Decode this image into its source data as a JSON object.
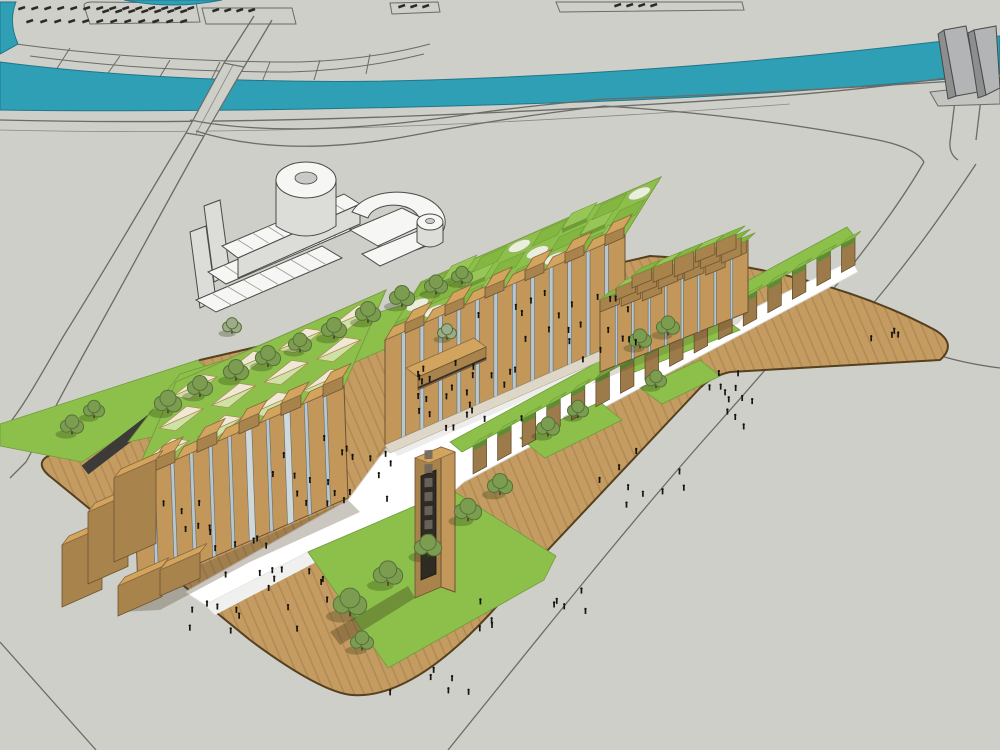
{
  "meta": {
    "kind": "3d-architectural-site-rendering",
    "style": "sketchup-massing-model",
    "view": "aerial-oblique"
  },
  "palette": {
    "ground": "#cfcfc9",
    "roadline": "#6b6b67",
    "river": "#2f9fb5",
    "riverdark": "#20768a",
    "deck": "#c49b61",
    "deckedge": "#55401f",
    "walk": "#ffffff",
    "path": "#3c3b37",
    "lawn": "#8cc04a",
    "lawndark": "#6f9c39",
    "roofgreen": "#8cc04a",
    "woodA": "#c29759",
    "woodB": "#a9834c",
    "woodtop": "#d3a45e",
    "glass": "#b9c6cb",
    "glassdark": "#8fa3ab",
    "whitebldg": "#f6f6f4",
    "whiteside": "#dcdcd9",
    "tower": "#b3b4b6",
    "towerside": "#8c8e90",
    "people": "#16140f",
    "treefill": "#7c9d50",
    "treedark": "#55713a",
    "treesage": "#9cab88",
    "cream": "#efe8d4",
    "pyrgreen": "#cfe2a6"
  },
  "scene": {
    "hatch_rows": [
      {
        "x": 18,
        "y": 8,
        "n": 14,
        "step": 13
      },
      {
        "x": 26,
        "y": 21,
        "n": 12,
        "step": 14
      },
      {
        "x": 102,
        "y": 11,
        "n": 7,
        "step": 13
      },
      {
        "x": 212,
        "y": 10,
        "n": 4,
        "step": 12
      },
      {
        "x": 398,
        "y": 6,
        "n": 3,
        "step": 12
      },
      {
        "x": 614,
        "y": 5,
        "n": 4,
        "step": 12
      }
    ],
    "left_building": {
      "front": [
        [
          138,
          590
        ],
        [
          348,
          498
        ],
        [
          344,
          386
        ],
        [
          134,
          478
        ]
      ],
      "roof": [
        [
          134,
          478
        ],
        [
          344,
          386
        ],
        [
          386,
          290
        ],
        [
          176,
          382
        ]
      ],
      "pyramid_grid": {
        "cols": 4,
        "rows": 3
      },
      "glass_slots": 10,
      "door_slots": [
        6,
        8
      ],
      "top_blocks": 10,
      "wings": [
        {
          "x": 62,
          "y": 545,
          "w": 40,
          "h": 62
        },
        {
          "x": 88,
          "y": 512,
          "w": 40,
          "h": 72
        },
        {
          "x": 114,
          "y": 478,
          "w": 42,
          "h": 84
        },
        {
          "x": 118,
          "y": 586,
          "w": 44,
          "h": 30
        },
        {
          "x": 160,
          "y": 570,
          "w": 40,
          "h": 26
        }
      ]
    },
    "middle_building": {
      "front": [
        [
          385,
          445
        ],
        [
          625,
          340
        ],
        [
          625,
          235
        ],
        [
          385,
          340
        ]
      ],
      "roof": [
        [
          385,
          340
        ],
        [
          625,
          235
        ],
        [
          661,
          177
        ],
        [
          421,
          282
        ]
      ],
      "cube_grid": {
        "cols": 8,
        "rows": 3
      },
      "glass_slots": 12,
      "top_blocks": 12,
      "canopy": {
        "top": [
          [
            406,
            368
          ],
          [
            474,
            338
          ],
          [
            486,
            347
          ],
          [
            418,
            377
          ]
        ],
        "face": [
          [
            418,
            377
          ],
          [
            486,
            347
          ],
          [
            486,
            360
          ],
          [
            418,
            390
          ]
        ]
      }
    },
    "right_building": {
      "front": [
        [
          600,
          372
        ],
        [
          748,
          312
        ],
        [
          748,
          240
        ],
        [
          600,
          300
        ]
      ],
      "terrace_rows": 3,
      "glass_slots": 8
    },
    "colonnade": {
      "a": [
        855,
        265
      ],
      "b": [
        462,
        480
      ],
      "posts": 16,
      "post_h": 28
    },
    "sign_tower": {
      "face": [
        [
          415,
          598
        ],
        [
          441,
          587
        ],
        [
          441,
          447
        ],
        [
          415,
          458
        ]
      ],
      "side": [
        [
          441,
          587
        ],
        [
          455,
          592
        ],
        [
          455,
          452
        ],
        [
          441,
          447
        ]
      ],
      "top": [
        [
          415,
          458
        ],
        [
          441,
          447
        ],
        [
          455,
          452
        ],
        [
          429,
          463
        ]
      ],
      "panel": [
        [
          421,
          580
        ],
        [
          436,
          574
        ],
        [
          436,
          470
        ],
        [
          421,
          476
        ]
      ],
      "glyphs": 7
    },
    "trees": [
      [
        168,
        408,
        13
      ],
      [
        200,
        392,
        12
      ],
      [
        236,
        376,
        12
      ],
      [
        268,
        362,
        12
      ],
      [
        300,
        348,
        11
      ],
      [
        334,
        334,
        12
      ],
      [
        368,
        318,
        12
      ],
      [
        402,
        302,
        12
      ],
      [
        436,
        290,
        11
      ],
      [
        462,
        280,
        10
      ],
      [
        72,
        430,
        11
      ],
      [
        94,
        414,
        10
      ],
      [
        350,
        610,
        16
      ],
      [
        388,
        580,
        14
      ],
      [
        428,
        552,
        13
      ],
      [
        468,
        516,
        13
      ],
      [
        500,
        490,
        12
      ],
      [
        362,
        646,
        11
      ],
      [
        548,
        432,
        11
      ],
      [
        578,
        414,
        10
      ],
      [
        656,
        384,
        10
      ],
      [
        640,
        344,
        11
      ],
      [
        668,
        331,
        11
      ],
      [
        232,
        330,
        9
      ],
      [
        447,
        336,
        9
      ]
    ],
    "sage_tree_indices": [
      23,
      24
    ],
    "people_clusters": [
      {
        "cx": 560,
        "cy": 328,
        "rx": 85,
        "ry": 38,
        "n": 22
      },
      {
        "cx": 468,
        "cy": 396,
        "rx": 80,
        "ry": 40,
        "n": 26
      },
      {
        "cx": 336,
        "cy": 478,
        "rx": 66,
        "ry": 38,
        "n": 20
      },
      {
        "cx": 243,
        "cy": 556,
        "rx": 55,
        "ry": 28,
        "n": 10
      },
      {
        "cx": 252,
        "cy": 622,
        "rx": 66,
        "ry": 28,
        "n": 9
      },
      {
        "cx": 430,
        "cy": 688,
        "rx": 48,
        "ry": 20,
        "n": 6
      },
      {
        "cx": 728,
        "cy": 402,
        "rx": 38,
        "ry": 42,
        "n": 12
      },
      {
        "cx": 636,
        "cy": 478,
        "rx": 52,
        "ry": 34,
        "n": 9
      },
      {
        "cx": 182,
        "cy": 520,
        "rx": 38,
        "ry": 24,
        "n": 6
      },
      {
        "cx": 302,
        "cy": 592,
        "rx": 46,
        "ry": 18,
        "n": 6
      },
      {
        "cx": 876,
        "cy": 342,
        "rx": 26,
        "ry": 12,
        "n": 4
      },
      {
        "cx": 560,
        "cy": 610,
        "rx": 40,
        "ry": 22,
        "n": 5
      },
      {
        "cx": 475,
        "cy": 620,
        "rx": 30,
        "ry": 18,
        "n": 4
      }
    ]
  }
}
